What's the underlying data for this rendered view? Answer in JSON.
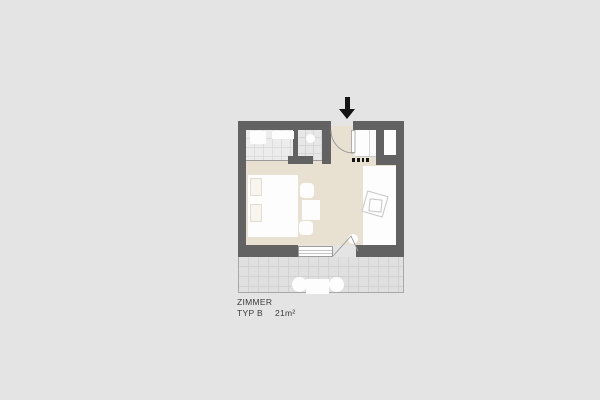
{
  "colors": {
    "bg": "#e4e4e4",
    "wall": "#626262",
    "floor": "#e8e0d1",
    "tile": "#ececec",
    "tile_grid": "#dcdcdc",
    "shower": "#e7e7e7",
    "shower_grid": "#d6d6d6",
    "terrace": "#e0e0e0",
    "terrace_grid": "#d2d2d2",
    "terrace_border": "#a8a8a8",
    "white": "#fdfdfd",
    "line": "#9a9a9a",
    "sketch": "#c6c6c6",
    "text": "#3b3b3b",
    "black": "#141414"
  },
  "plan_label": {
    "title": "ZIMMER",
    "type": "TYP B",
    "area": "21m²"
  },
  "icons": {
    "entrance_arrow": "↓"
  }
}
